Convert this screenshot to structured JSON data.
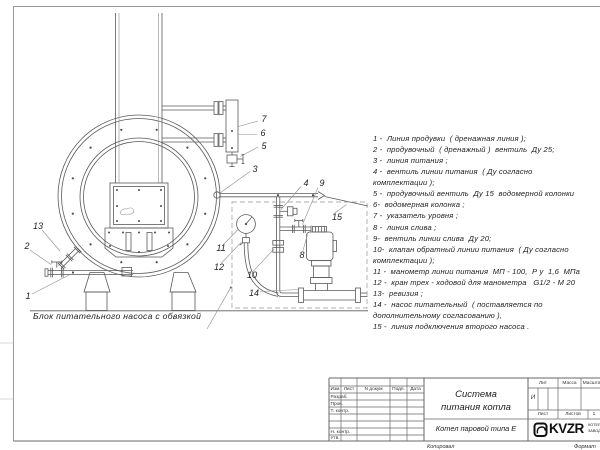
{
  "legend": {
    "lines": [
      "1 -  Линия продувки  ( дренажная линия );",
      "2 -  продувочный  ( дренажный )  вентиль  Ду 25;",
      "3 -  линия питания ;",
      "4 -  вентиль линии питания  ( Ду согласно",
      "комплектации );",
      "5 -  продувочный вентиль  Ду 15  водомерной колонки",
      "6-  водомерная колонка ;",
      "7 -  указатель уровня ;",
      "8 -  линия слива ;",
      "9-  вентиль линии слива  Ду 20;",
      "10-  клапан обратный линии питания  ( Ду согласно",
      "комплектации );",
      "11 -  манометр линии питания  МП - 100,  Р у  1,6  МПа",
      "12 -  кран трех - ходовой для манометра   G1/2 - М 20",
      "13-  ревизия ;",
      "14 -  насос питательный  ( поставляется по",
      "дополнительному согласованию ),",
      "15 -  линия подключения второго насоса ."
    ]
  },
  "drawing": {
    "caption": "Блок питательного насоса с обвязкой",
    "callouts": [
      {
        "label": "1",
        "x": 28,
        "y": 296
      },
      {
        "label": "2",
        "x": 27,
        "y": 246
      },
      {
        "label": "3",
        "x": 255,
        "y": 169
      },
      {
        "label": "4",
        "x": 306,
        "y": 183
      },
      {
        "label": "5",
        "x": 264,
        "y": 146
      },
      {
        "label": "6",
        "x": 263,
        "y": 133
      },
      {
        "label": "7",
        "x": 264,
        "y": 119
      },
      {
        "label": "8",
        "x": 302,
        "y": 255
      },
      {
        "label": "9",
        "x": 322,
        "y": 183
      },
      {
        "label": "10",
        "x": 252,
        "y": 275
      },
      {
        "label": "11",
        "x": 221,
        "y": 248
      },
      {
        "label": "12",
        "x": 219,
        "y": 267
      },
      {
        "label": "13",
        "x": 38,
        "y": 226
      },
      {
        "label": "14",
        "x": 254,
        "y": 293
      },
      {
        "label": "15",
        "x": 337,
        "y": 217
      }
    ]
  },
  "title_block": {
    "doc_title_line1": "Система",
    "doc_title_line2": "питания котла",
    "product": "Котел паровой типа Е",
    "columns": {
      "izm": "Изм",
      "list": "Лист",
      "n_dokum": "N докум",
      "podp": "Подп.",
      "data": "Дата"
    },
    "rows": {
      "razrab": "Разраб.",
      "prov": "Пров.",
      "t_kontr": "Т. контр.",
      "n_kontr": "Н. контр.",
      "utv": "Утв."
    },
    "lit_label": "Лит",
    "massa_label": "Масса",
    "masshtab_label": "Масштаб",
    "lit_value": "И",
    "list_label": "Лист",
    "listov_label": "Листов",
    "listov_value": "1",
    "logo_text": "KVZR",
    "logo_sub1": "КОТЕЛЬНЫЙ",
    "logo_sub2": "ЗАВОД Р",
    "kopiroval": "Копировал",
    "format": "Формат"
  },
  "colors": {
    "line": "#5a5a5a",
    "leader": "#8f8f8f",
    "text": "#222222",
    "frame": "#9a9a9a"
  }
}
